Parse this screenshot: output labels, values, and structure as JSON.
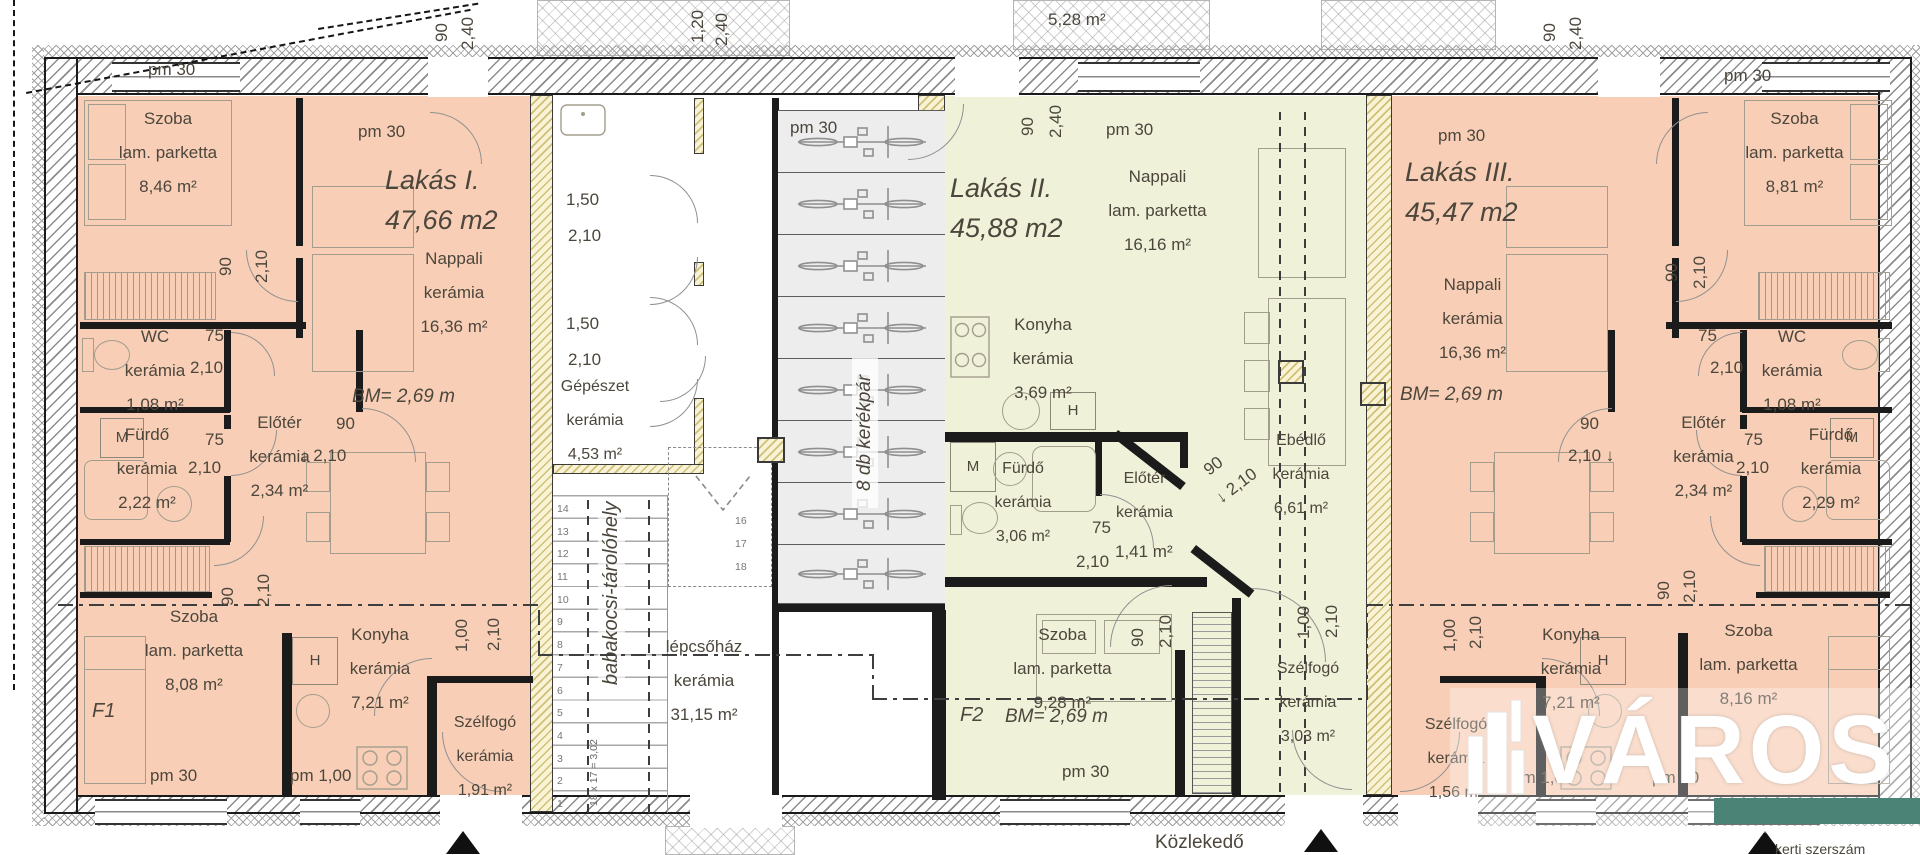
{
  "colors": {
    "apartment_1_3": "#f8cfb6",
    "apartment_2": "#f0f1d9",
    "logo_band": "#4b8377",
    "wall": "#1b1b1b"
  },
  "lakas1": {
    "title": "Lakás I.",
    "area_total": "47,66 m2",
    "bm": "BM= 2,69 m",
    "marker": "F1",
    "szoba_felso": {
      "name": "Szoba",
      "finish": "lam. parketta",
      "area": "8,46 m²"
    },
    "wc": {
      "name": "WC",
      "finish": "kerámia",
      "area": "1,08 m²"
    },
    "furdo": {
      "name": "Fürdő",
      "finish": "kerámia",
      "area": "2,22 m²"
    },
    "eloter": {
      "name": "Előtér",
      "finish": "kerámia",
      "area": "2,34 m²"
    },
    "nappali": {
      "name": "Nappali",
      "finish": "kerámia",
      "area": "16,36 m²"
    },
    "szoba_also": {
      "name": "Szoba",
      "finish": "lam. parketta",
      "area": "8,08 m²"
    },
    "konyha": {
      "name": "Konyha",
      "finish": "kerámia",
      "area": "7,21 m²"
    },
    "szelfogo": {
      "name": "Szélfogó",
      "finish": "kerámia",
      "area": "1,91 m²"
    }
  },
  "lakas2": {
    "title": "Lakás II.",
    "area_total": "45,88 m2",
    "bm": "BM= 2,69 m",
    "marker": "F2",
    "nappali": {
      "name": "Nappali",
      "finish": "lam. parketta",
      "area": "16,16 m²"
    },
    "konyha": {
      "name": "Konyha",
      "finish": "kerámia",
      "area": "3,69 m²"
    },
    "furdo": {
      "name": "Fürdő",
      "finish": "kerámia",
      "area": "3,06 m²"
    },
    "eloter": {
      "name": "Előtér",
      "finish": "kerámia",
      "area": "1,41 m²"
    },
    "ebedlo": {
      "name": "Ebédlő",
      "finish": "kerámia",
      "area": "6,61 m²"
    },
    "szoba": {
      "name": "Szoba",
      "finish": "lam. parketta",
      "area": "9,28 m²"
    },
    "szelfogo": {
      "name": "Szélfogó",
      "finish": "kerámia",
      "area": "3,03 m²"
    }
  },
  "lakas3": {
    "title": "Lakás III.",
    "area_total": "45,47 m2",
    "bm": "BM= 2,69 m",
    "szoba_felso": {
      "name": "Szoba",
      "finish": "lam. parketta",
      "area": "8,81 m²"
    },
    "wc": {
      "name": "WC",
      "finish": "kerámia",
      "area": "1,08 m²"
    },
    "furdo": {
      "name": "Fürdő",
      "finish": "kerámia",
      "area": "2,29 m²"
    },
    "eloter": {
      "name": "Előtér",
      "finish": "kerámia",
      "area": "2,34 m²"
    },
    "nappali": {
      "name": "Nappali",
      "finish": "kerámia",
      "area": "16,36 m²"
    },
    "szoba_also": {
      "name": "Szoba",
      "finish": "lam. parketta",
      "area": "8,16 m²"
    },
    "konyha": {
      "name": "Konyha",
      "finish": "kerámia",
      "area": "7,21 m²"
    },
    "szelfogo": {
      "name": "Szélfogó",
      "finish": "kerámia",
      "area": "1,56 m²"
    }
  },
  "kozos": {
    "gepeszet": {
      "name": "Gépészet",
      "finish": "kerámia",
      "area": "4,53 m²"
    },
    "lepcsohaz": {
      "name": "lépcsőház",
      "finish": "kerámia",
      "area": "31,15 m²"
    },
    "babakocsi_1": "babakocsi-tároló",
    "babakocsi_2": "hely",
    "kerekpar": "8 db kerékpár",
    "stair_note": "18 x 17 = 3,02",
    "stair_steps_lower": [
      "14",
      "13",
      "12",
      "11",
      "10",
      "9",
      "8",
      "7",
      "6",
      "5",
      "4",
      "3",
      "2",
      "1"
    ],
    "stair_steps_upper": [
      "16",
      "17",
      "18"
    ],
    "kozlekedo": "Közlekedő"
  },
  "dims": {
    "pm30": "pm 30",
    "pm100": "pm 1,00",
    "w90": "90",
    "h210": "2,10",
    "h240": "2,40",
    "w120": "1,20",
    "w150": "1,50",
    "w75": "75",
    "w100": "1,00",
    "down210": "↓ 2,10",
    "down210b": "2,10 ↓",
    "porch_area": "5,28 m²",
    "h": "H",
    "m": "M"
  },
  "egyeb": {
    "kerti": "kerti szerszám"
  },
  "logo": {
    "text": "VÁROS"
  }
}
